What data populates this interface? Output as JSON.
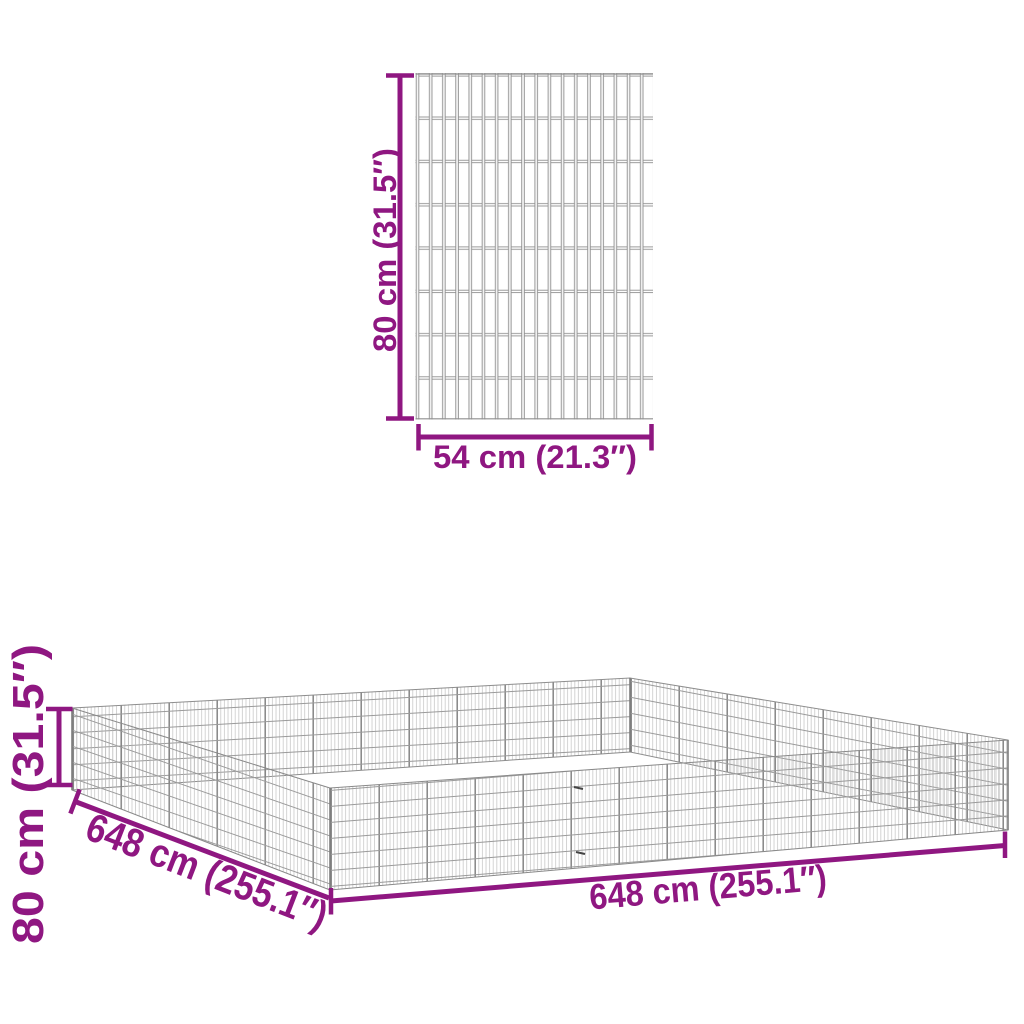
{
  "colors": {
    "dimension": "#8F1781",
    "wire_dark": "#8f8f8f",
    "wire_mid": "#9a9a9a",
    "wire_light": "#b7b7b7",
    "background": "#ffffff"
  },
  "panel_diagram": {
    "name": "single mesh panel front view",
    "height_label": "80 cm (31.5″)",
    "width_label": "54 cm (21.3″)"
  },
  "enclosure_diagram": {
    "name": "assembled square pen perspective view",
    "height_label": "80 cm (31.5″)",
    "left_edge_label": "648 cm (255.1″)",
    "front_edge_label": "648 cm (255.1″)"
  }
}
